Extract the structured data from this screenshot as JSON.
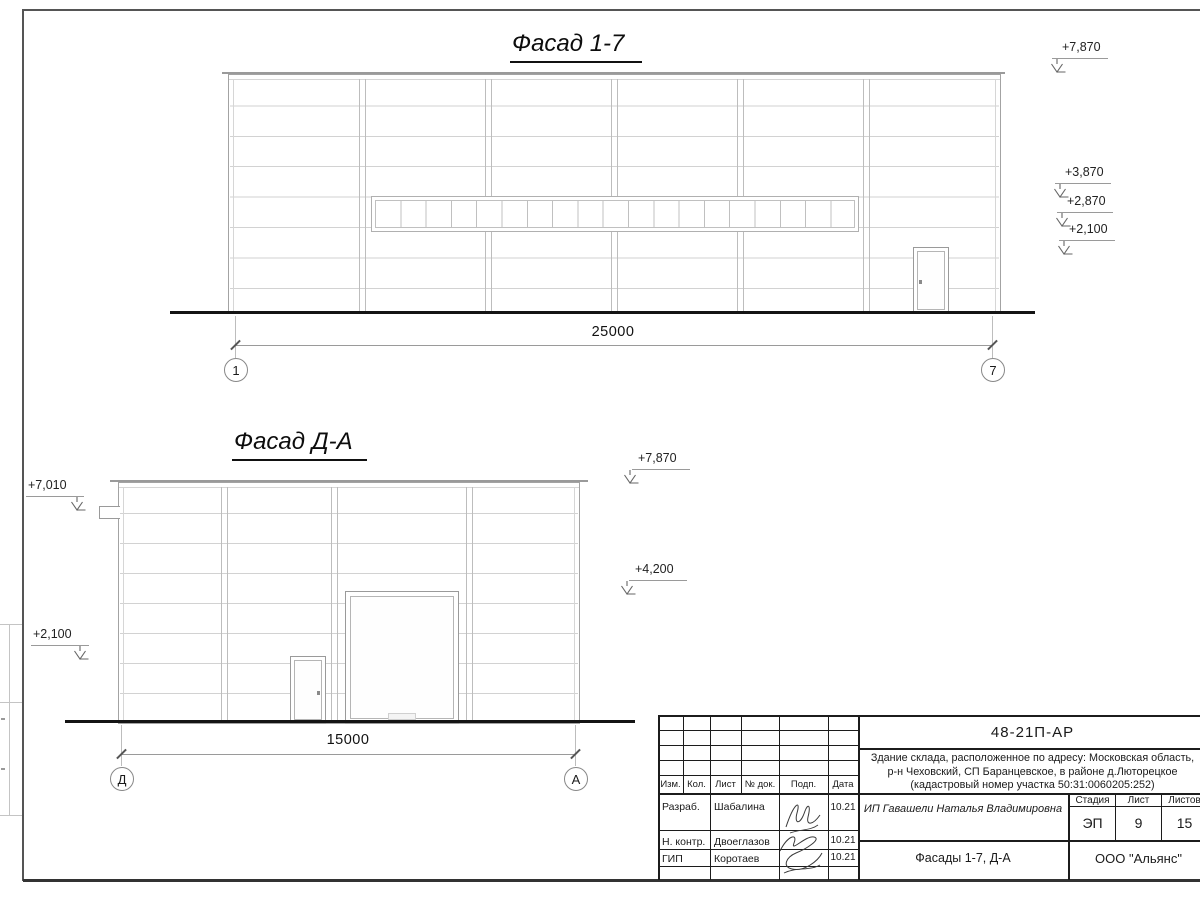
{
  "facade17": {
    "title": "Фасад 1-7",
    "dimension": "25000",
    "grid_left": "1",
    "grid_right": "7",
    "elevations": [
      "+7,870",
      "+3,870",
      "+2,870",
      "+2,100"
    ]
  },
  "facadeDA": {
    "title": "Фасад Д-А",
    "dimension": "15000",
    "grid_left": "Д",
    "grid_right": "А",
    "elev_left_top": "+7,010",
    "elev_left_mid": "+2,100",
    "elev_right_top": "+7,870",
    "elev_right_mid": "+4,200"
  },
  "titleblock": {
    "doc_number": "48-21П-АР",
    "project_line1": "Здание склада, расположенное по адресу: Московская область,",
    "project_line2": "р-н Чеховский, СП Баранцевское, в районе д.Люторецкое",
    "project_line3": "(кадастровый номер участка 50:31:0060205:252)",
    "header_cols": [
      "Изм.",
      "Кол.",
      "Лист",
      "№ док.",
      "Подп.",
      "Дата"
    ],
    "rows": [
      {
        "role": "Разраб.",
        "name": "Шабалина",
        "date": "10.21"
      },
      {
        "role": "Н. контр.",
        "name": "Двоеглазов",
        "date": "10.21"
      },
      {
        "role": "ГИП",
        "name": "Коротаев",
        "date": "10.21"
      }
    ],
    "client": "ИП Гавашели Наталья Владимировна",
    "sheet_title": "Фасады 1-7, Д-А",
    "stage_label": "Стадия",
    "sheet_label": "Лист",
    "sheets_label": "Листов",
    "stage": "ЭП",
    "sheet_num": "9",
    "sheets_total": "15",
    "company": "ООО \"Альянс\""
  }
}
